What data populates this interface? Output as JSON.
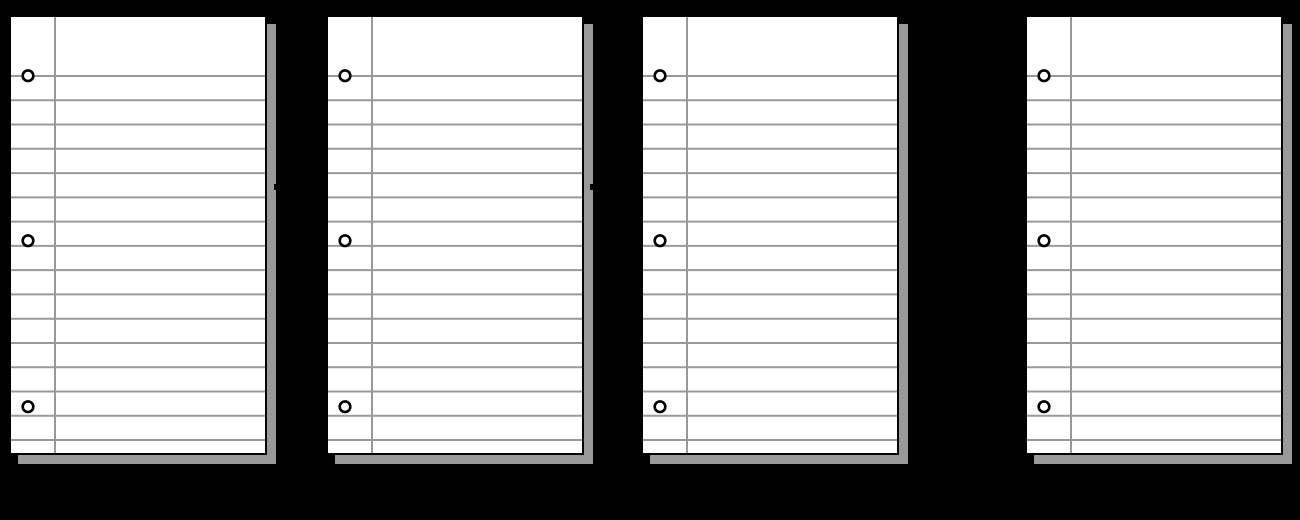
{
  "scene": {
    "width": 1300,
    "height": 520,
    "background_color": "#000000",
    "description": "Four blank lined notebook-paper sheets in a row on a black background"
  },
  "papers": [
    {
      "id": "notebook-paper-1",
      "left": 9,
      "top": 15
    },
    {
      "id": "notebook-paper-2",
      "left": 326,
      "top": 15
    },
    {
      "id": "notebook-paper-3",
      "left": 641,
      "top": 15
    },
    {
      "id": "notebook-paper-4",
      "left": 1025,
      "top": 15
    }
  ],
  "paper_style": {
    "width": 258,
    "height": 440,
    "fill": "#ffffff",
    "border_color": "#000000",
    "border_width": 2,
    "line_color": "#999999",
    "line_width": 2,
    "first_line_y": 61,
    "line_spacing": 24.27,
    "line_count": 16,
    "margin_line_x": 46,
    "hole_cx": 19,
    "hole_cy": [
      60.7,
      225.7,
      391.7
    ],
    "hole_radius": 5.3,
    "hole_stroke_width": 2.6,
    "hole_stroke_color": "#000000",
    "hole_fill": "#ffffff",
    "shadow_color": "#999999",
    "shadow_offset": 8.5
  },
  "shadow_notches": [
    {
      "left": 273.5,
      "top": 184,
      "width": 2.5,
      "height": 6
    },
    {
      "left": 590.0,
      "top": 184,
      "width": 2.5,
      "height": 6
    }
  ]
}
